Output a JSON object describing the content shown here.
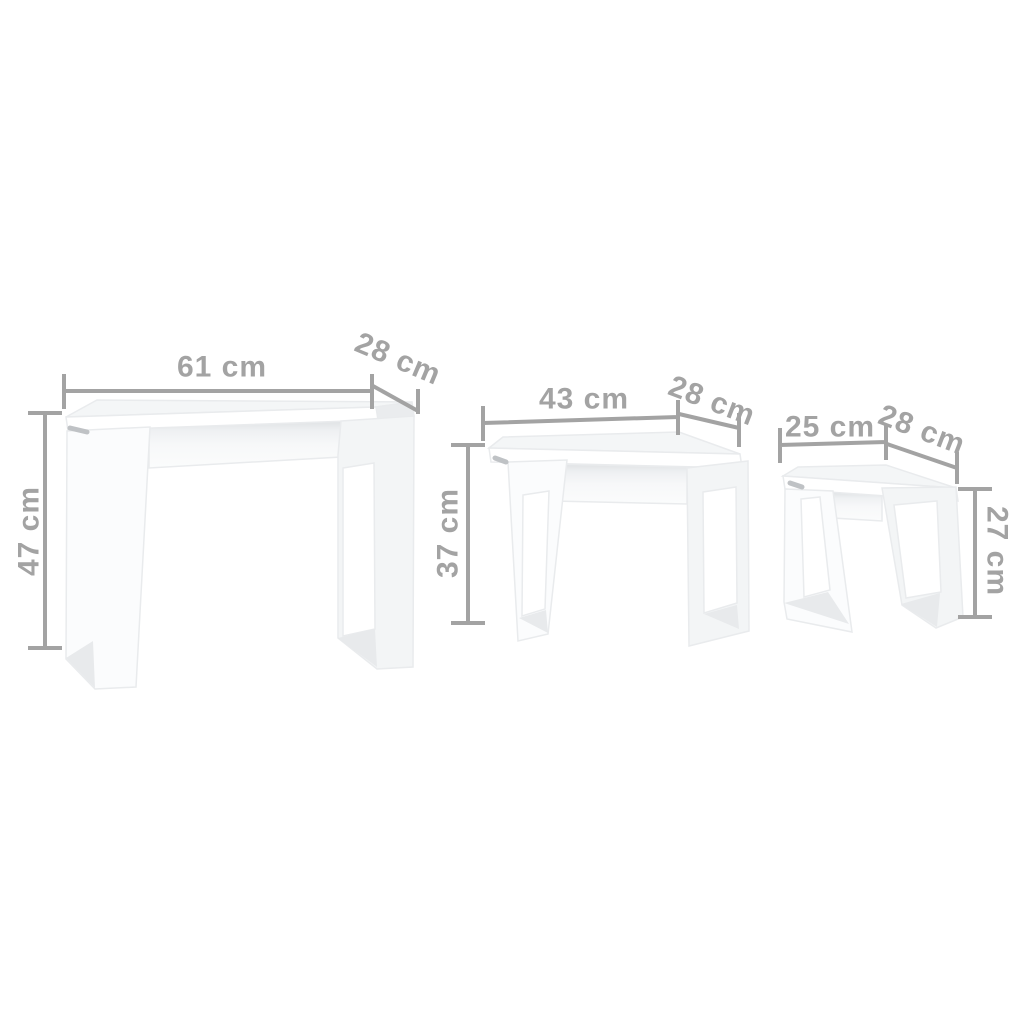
{
  "diagram": {
    "background_color": "#ffffff",
    "annotation_color": "#a3a3a3",
    "furniture_color": "#ffffff",
    "tables": [
      {
        "id": "large",
        "width": "61 cm",
        "depth": "28 cm",
        "height": "47 cm"
      },
      {
        "id": "medium",
        "width": "43 cm",
        "depth": "28 cm",
        "height": "37 cm"
      },
      {
        "id": "small",
        "width": "25 cm",
        "depth": "28 cm",
        "height": "27 cm"
      }
    ]
  }
}
